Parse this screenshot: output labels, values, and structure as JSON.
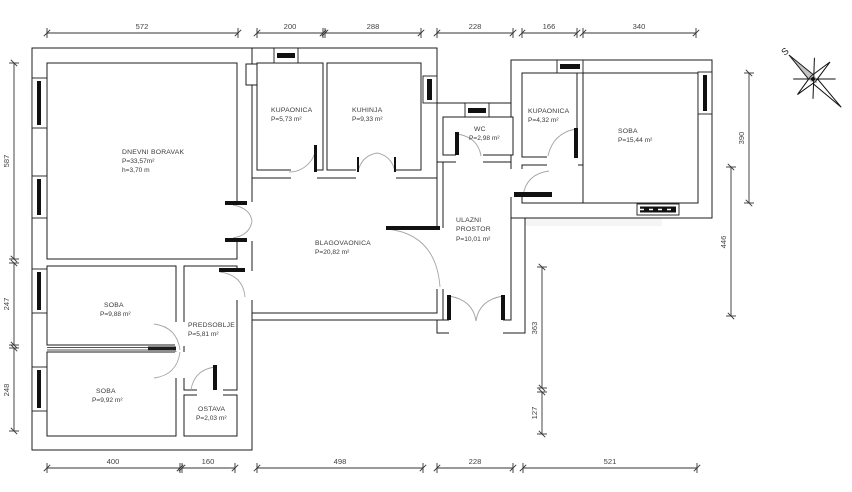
{
  "compass": {
    "north_label": "S"
  },
  "rooms": [
    {
      "id": "dnevni-boravak",
      "name": "DNEVNI BORAVAK",
      "area": "P=33,57m²",
      "height": "h=3,70 m"
    },
    {
      "id": "kupaonica-1",
      "name": "KUPAONICA",
      "area": "P=5,73 m²"
    },
    {
      "id": "kuhinja",
      "name": "KUHINJA",
      "area": "P=9,33 m²"
    },
    {
      "id": "wc",
      "name": "WC",
      "area": "P=2,98 m²"
    },
    {
      "id": "kupaonica-2",
      "name": "KUPAONICA",
      "area": "P=4,32 m²"
    },
    {
      "id": "soba-velika",
      "name": "SOBA",
      "area": "P=15,44 m²"
    },
    {
      "id": "ulazni-prostor",
      "name": "ULAZNI",
      "name_line2": "PROSTOR",
      "area": "P=10,01 m²"
    },
    {
      "id": "blagovaonica",
      "name": "BLAGOVAONICA",
      "area": "P=20,82 m²"
    },
    {
      "id": "soba-1",
      "name": "SOBA",
      "area": "P=9,88 m²"
    },
    {
      "id": "predsoblje",
      "name": "PREDSOBLJE",
      "area": "P=5,81 m²"
    },
    {
      "id": "soba-2",
      "name": "SOBA",
      "area": "P=9,92 m²"
    },
    {
      "id": "ostava",
      "name": "OSTAVA",
      "area": "P=2,03 m²"
    }
  ],
  "dimensions": {
    "top": [
      "572",
      "200",
      "288",
      "228",
      "166",
      "340"
    ],
    "bottom": [
      "400",
      "160",
      "498",
      "228",
      "521"
    ],
    "left": [
      "587",
      "247",
      "248"
    ],
    "right": [
      "390",
      "446"
    ],
    "middle": [
      "363",
      "127"
    ]
  }
}
